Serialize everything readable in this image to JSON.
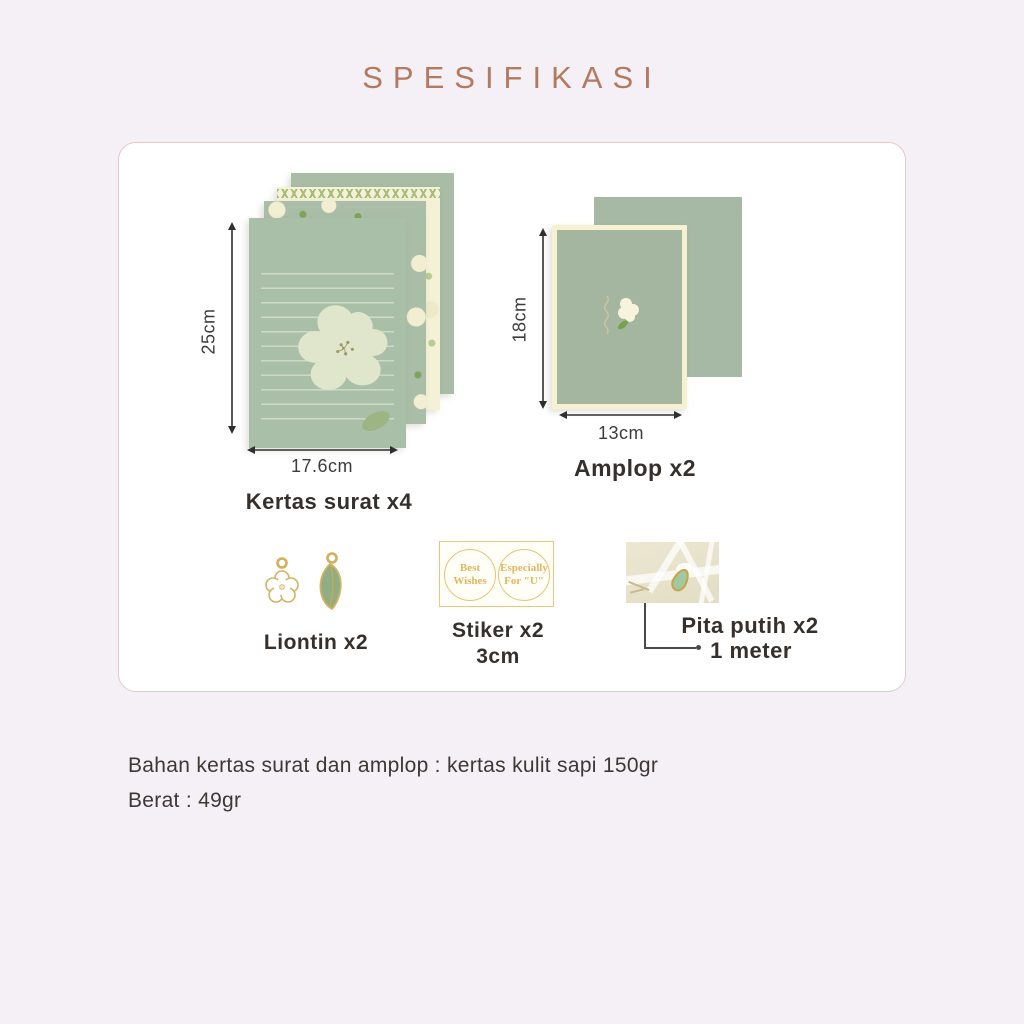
{
  "title": "SPESIFIKASI",
  "items": {
    "letter_paper": {
      "label": "Kertas surat x4",
      "height_label": "25cm",
      "width_label": "17.6cm"
    },
    "envelope": {
      "label": "Amplop x2",
      "height_label": "18cm",
      "width_label": "13cm"
    },
    "pendant": {
      "label": "Liontin x2"
    },
    "sticker": {
      "label": "Stiker x2",
      "size_label": "3cm",
      "sticker1_text": "Best Wishes",
      "sticker2_text": "Especially For \"U\""
    },
    "ribbon": {
      "label": "Pita putih x2",
      "length_label": "1 meter"
    }
  },
  "footer": {
    "line1": "Bahan kertas surat dan amplop : kertas kulit sapi 150gr",
    "line2": "Berat : 49gr"
  },
  "colors": {
    "background": "#f5f0f6",
    "title_accent": "#b27a5f",
    "card_border": "#e2cbc6",
    "sage_green": "#aabfa8",
    "cream_paper": "#f4f1d6",
    "gold": "#e8b55f",
    "label_text": "#36302d"
  }
}
